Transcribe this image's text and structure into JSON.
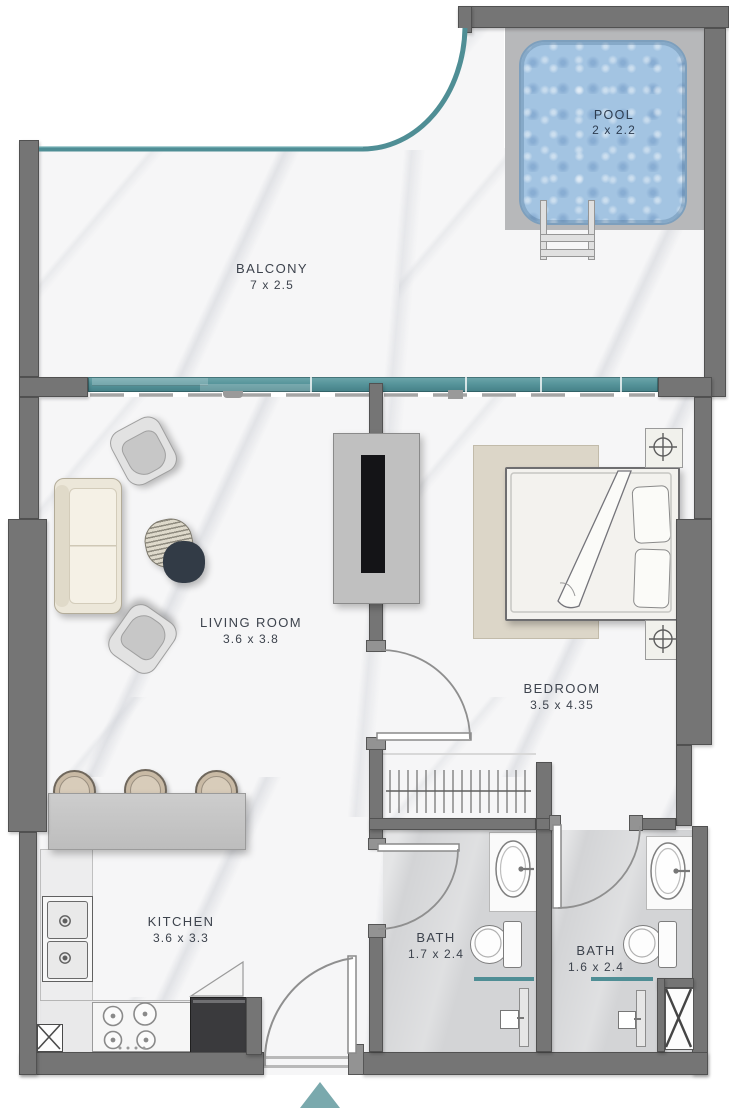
{
  "rooms": {
    "pool": {
      "name": "POOL",
      "dims": "2 x 2.2"
    },
    "balcony": {
      "name": "BALCONY",
      "dims": "7 x 2.5"
    },
    "living": {
      "name": "LIVING ROOM",
      "dims": "3.6 x  3.8"
    },
    "bedroom": {
      "name": "BEDROOM",
      "dims": "3.5 x  4.35"
    },
    "kitchen": {
      "name": "KITCHEN",
      "dims": "3.6 x  3.3"
    },
    "bath1": {
      "name": "BATH",
      "dims": "1.7 x 2.4"
    },
    "bath2": {
      "name": "BATH",
      "dims": "1.6 x 2.4"
    }
  },
  "colors": {
    "wall": "#757575",
    "walledge": "#4f4f4f",
    "glass": "#4f8e95",
    "glasslight": "#74abb0",
    "floor": "#f6f6f7",
    "tile": "#d3d4d6",
    "deck": "#b7b8ba",
    "pool": "#a3c4e2",
    "pooledge": "#7d9fbd",
    "pooltext": "#2d3c50",
    "text": "#3d434d",
    "accent": "#7aa9ad",
    "cream": "#ece7d9",
    "dark": "#323b46"
  }
}
